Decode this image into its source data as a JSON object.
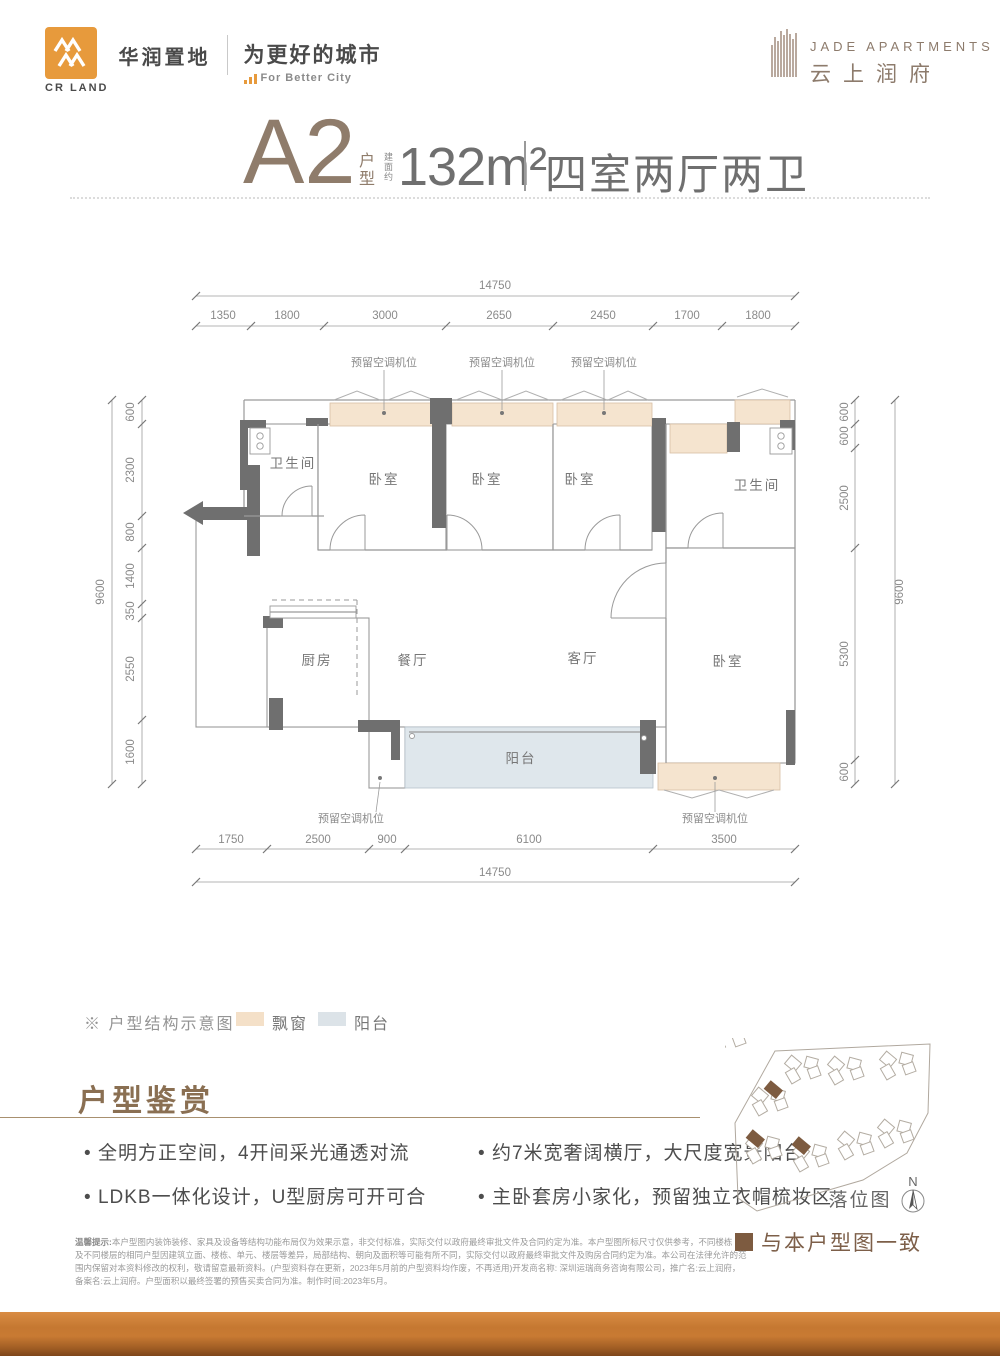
{
  "header": {
    "logo_cn": "华润置地",
    "logo_en": "CR LAND",
    "slogan_cn": "为更好的城市",
    "slogan_en": "For Better City",
    "project_en": "JADE APARTMENTS",
    "project_cn": "云上润府"
  },
  "title": {
    "unit": "A2",
    "unit_suffix": "户型",
    "area_prefix": "建面约",
    "area": "132m²",
    "rooms": "四室两厅两卫"
  },
  "plan": {
    "ac_label": "预留空调机位",
    "rooms": {
      "bathroom": "卫生间",
      "bedroom": "卧室",
      "kitchen": "厨房",
      "dining": "餐厅",
      "living": "客厅",
      "balcony": "阳台"
    },
    "dims": {
      "top_total": "14750",
      "top": [
        "1350",
        "1800",
        "3000",
        "2650",
        "2450",
        "1700",
        "1800"
      ],
      "bottom": [
        "1750",
        "2500",
        "900",
        "6100",
        "3500"
      ],
      "bottom_total": "14750",
      "left": [
        "600",
        "2300",
        "800",
        "1400",
        "350",
        "2550",
        "1600"
      ],
      "left_total": "9600",
      "right": [
        "600",
        "600",
        "2500",
        "5300",
        "600"
      ],
      "right_total": "9600"
    }
  },
  "legend": {
    "note": "※ 户型结构示意图",
    "bay_window": "飘窗",
    "balcony": "阳台"
  },
  "features": {
    "heading": "户型鉴赏",
    "bullets": [
      "全明方正空间，4开间采光通透对流",
      "LDKB一体化设计，U型厨房可开可合",
      "约7米宽奢阔横厅，大尺度宽景阳台",
      "主卧套房小家化，预留独立衣帽梳妆区"
    ]
  },
  "siteplan": {
    "label": "落位图",
    "north": "N",
    "legend": "与本户型图一致"
  },
  "disclaimer": {
    "label": "温馨提示:",
    "l1": "本户型图内装饰装修、家具及设备等结构功能布局仅为效果示意，非交付标准，实际交付以政府最终审批文件及合同约定为准。本户型图所标尺寸仅供参考，不同楼栋",
    "l2": "及不同楼层的相同户型因建筑立面、楼栋、单元、楼层等差异，局部结构、朝向及面积等可能有所不同，实际交付以政府最终审批文件及购房合同约定为准。本公司在法律允许的范",
    "l3": "围内保留对本资料修改的权利，敬请留意最新资料。(户型资料存在更新，2023年5月前的户型资料均作废，不再适用)开发商名称: 深圳运瑞商务咨询有限公司，推广名:云上润府，",
    "l4": "备案名:云上润府。户型面积以最终签署的预售买卖合同为准。制作时间:2023年5月。"
  },
  "colors": {
    "brand_orange": "#e79a3c",
    "brown": "#8a6f52",
    "bay_window": "#f5e4cf",
    "balcony": "#dfe7ec",
    "wall": "#6f6f6f"
  }
}
